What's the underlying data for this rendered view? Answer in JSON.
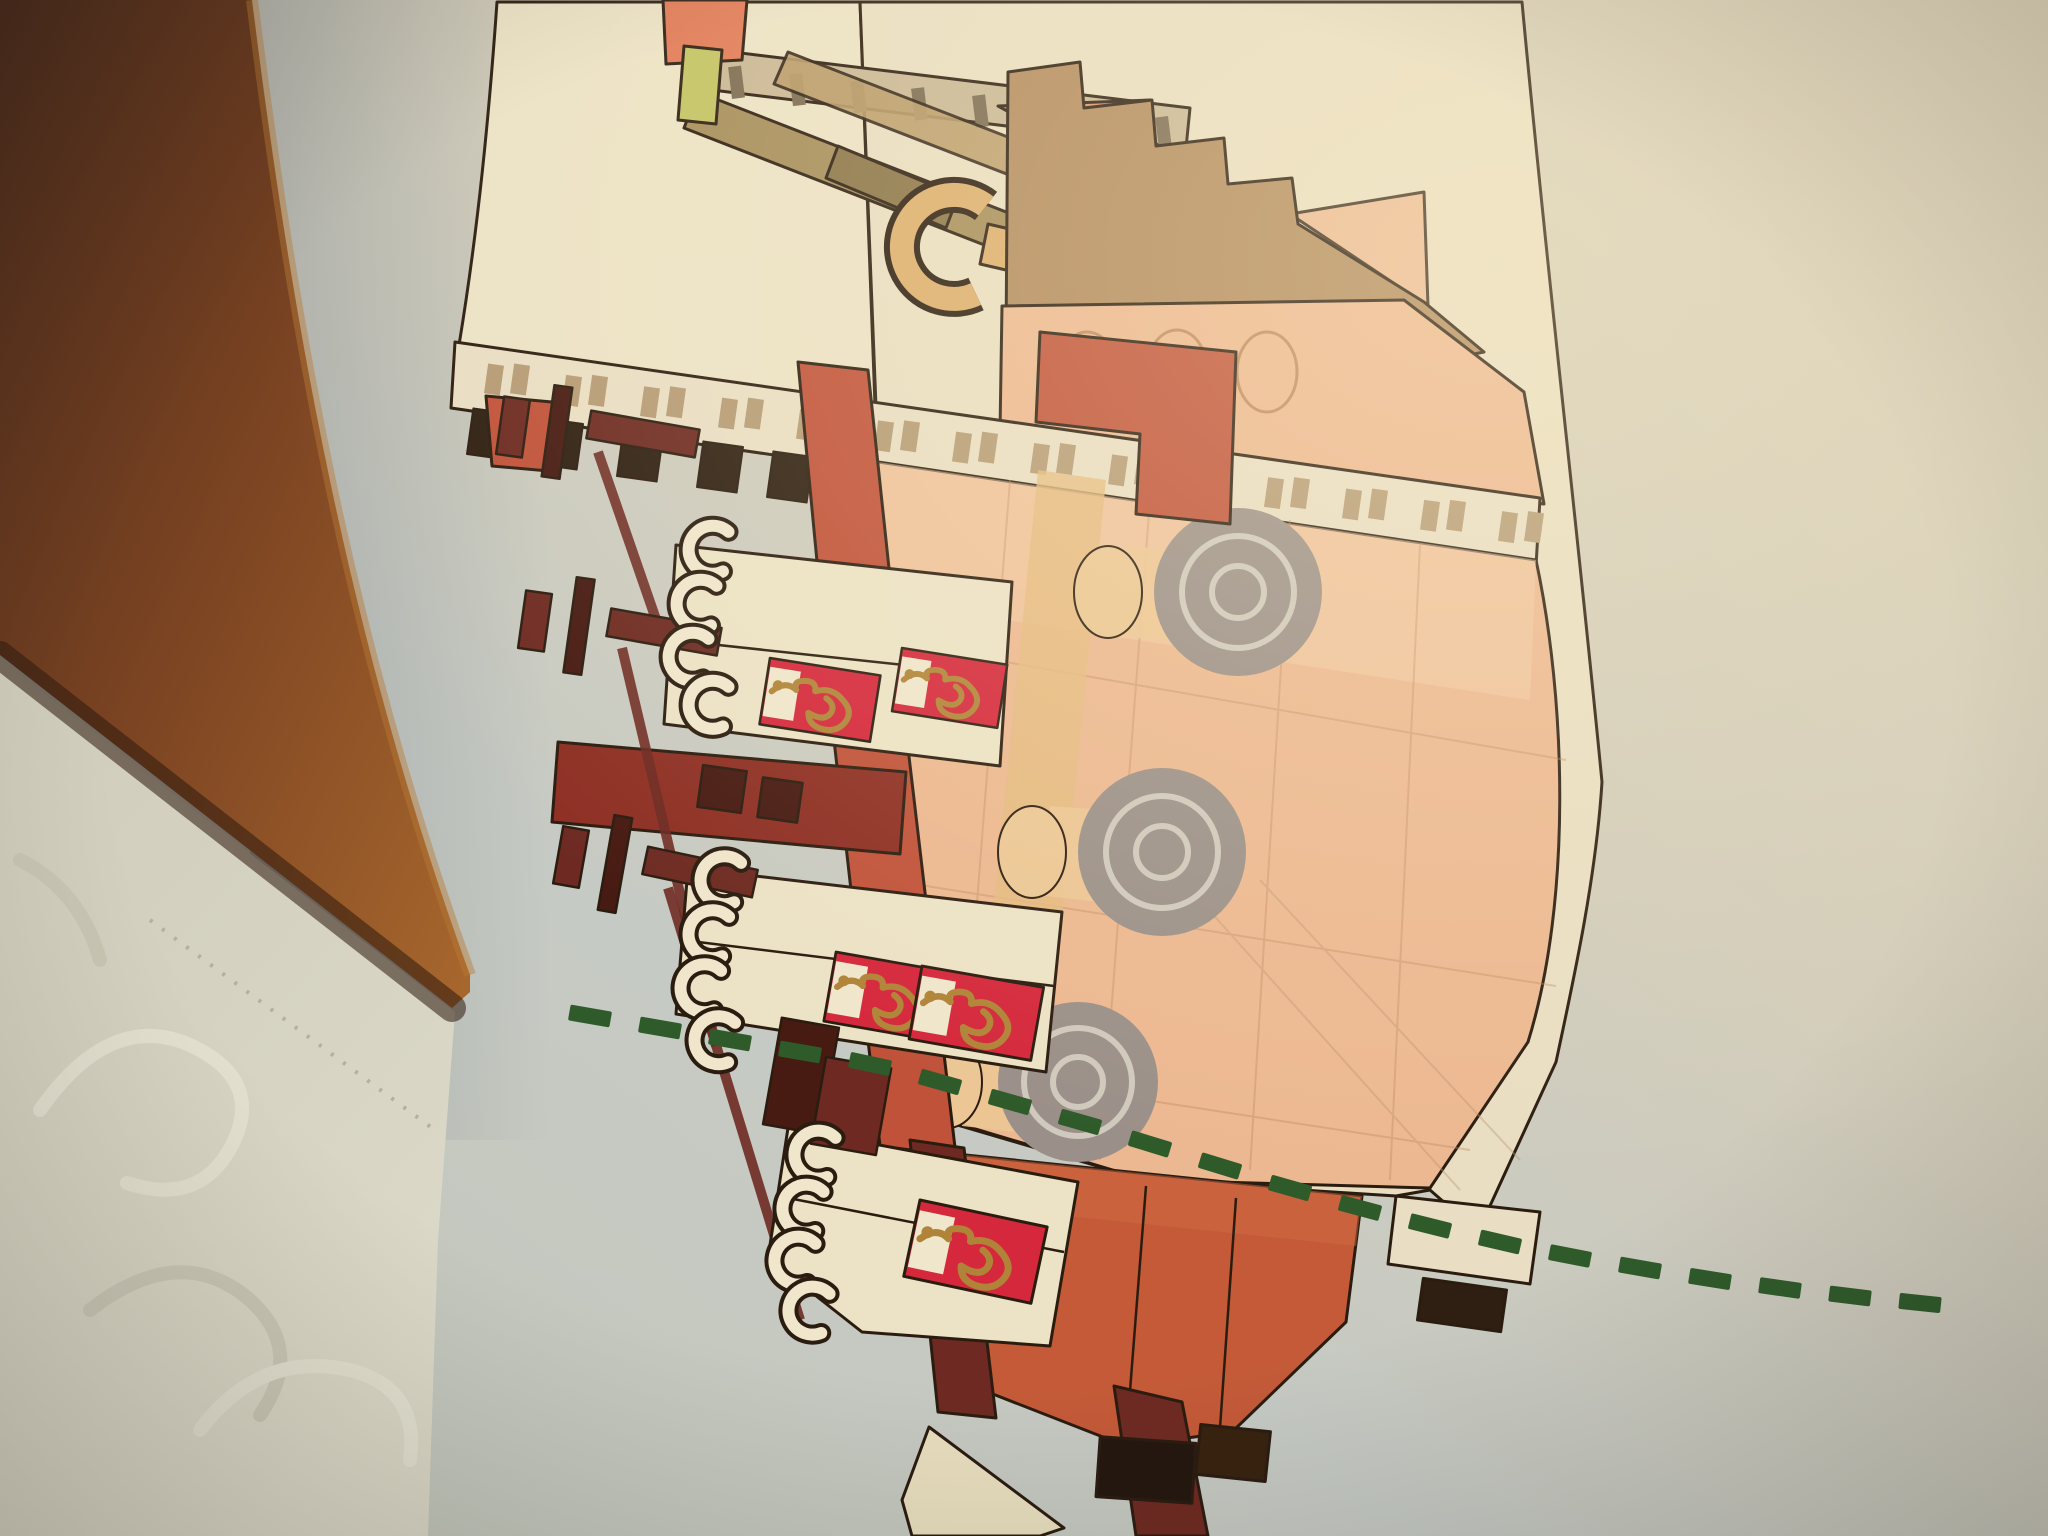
{
  "scene": {
    "description": "Photo of a LEGO instruction manual page showing a side-view illustration of a junk ship with batten sails, dragon emblems, peach hull and a dashed green waterline; page lies on a wooden table beside a white damask tablecloth",
    "objects": [
      "wooden-table",
      "damask-tablecloth",
      "instruction-page",
      "junk-ship-illustration",
      "batten-sails",
      "dragon-sail-panels",
      "hull",
      "stern-castle",
      "bowsprit",
      "figurehead",
      "keel",
      "rudder",
      "waterline"
    ]
  },
  "colors": {
    "outline": "#2b1c10",
    "wood_dark": "#48291a",
    "wood_mid": "#7c4422",
    "wood_light": "#a8672d",
    "wood_edge_hi": "#b97a35",
    "wood_shadow": "#2e1a0e",
    "cloth": "#d8d5c4",
    "cloth_lo": "#c6c3b1",
    "cloth_hi": "#e7e4d4",
    "stitch": "#b3b09e",
    "page_cool": "#c1c8ca",
    "page_mid": "#cdccba",
    "page_warm": "#dbd0b6",
    "sail_cream": "#ece2c6",
    "sail_cream2": "#e9dec2",
    "deck_plate": "#e9dec4",
    "plate_tick": "#b59b76",
    "teeth_dark": "#2e1f12",
    "flag_orange": "#e17a58",
    "flag_lime": "#c2c363",
    "spar_tan": "#a68d5b",
    "spar_dark": "#8a7448",
    "yard_tan": "#b99a68",
    "rail_tan": "#c9b796",
    "rail_post": "#7a6a52",
    "figurehead_tan": "#dcae6e",
    "brick_tan": "#d8a86a",
    "brick_tan2": "#e2bb80",
    "tri_orange": "#dc9368",
    "castle_brown": "#b28a5e",
    "castle_shadow": "#8f6b44",
    "hull_peach": "#ecb891",
    "hull_peach_light": "#f2cda9",
    "hull_seam": "#c08a60",
    "pencil": "#b9946f",
    "disc_gray": "#9b9089",
    "disc_ring": "#d0c9bd",
    "cyl_tan": "#ecc795",
    "tan_strip": "#e5ba80",
    "red_structure": "#c0523a",
    "red_dark": "#8e2f24",
    "keel_red": "#c45a38",
    "keel_hi": "#d06a44",
    "maroon": "#6e2a22",
    "maroon_dark": "#471a12",
    "panel_red": "#d5283c",
    "panel_cream": "#efe6cc",
    "dragon_gold": "#b08438",
    "waterline_green": "#2f5b2b",
    "rudder_cream": "#e9dfbf",
    "block_black": "#241710",
    "block_brown": "#38220f"
  },
  "waterline": {
    "dash_w": 42,
    "dash_h": 16,
    "dashes": [
      [
        590,
        1016,
        10
      ],
      [
        660,
        1028,
        10
      ],
      [
        730,
        1040,
        10
      ],
      [
        800,
        1052,
        10
      ],
      [
        870,
        1064,
        12
      ],
      [
        940,
        1082,
        16
      ],
      [
        1010,
        1102,
        16
      ],
      [
        1080,
        1122,
        16
      ],
      [
        1150,
        1144,
        17
      ],
      [
        1220,
        1166,
        17
      ],
      [
        1290,
        1188,
        16
      ],
      [
        1360,
        1208,
        15
      ],
      [
        1430,
        1226,
        14
      ],
      [
        1500,
        1242,
        13
      ],
      [
        1570,
        1256,
        11
      ],
      [
        1640,
        1268,
        10
      ],
      [
        1710,
        1279,
        9
      ],
      [
        1780,
        1288,
        8
      ],
      [
        1850,
        1296,
        7
      ],
      [
        1920,
        1303,
        6
      ]
    ]
  },
  "teeth": [
    [
      470,
      411
    ],
    [
      540,
      421
    ],
    [
      620,
      433
    ],
    [
      700,
      444
    ],
    [
      770,
      454
    ],
    [
      840,
      465
    ],
    [
      1050,
      495
    ],
    [
      1120,
      505
    ],
    [
      1190,
      516
    ],
    [
      1260,
      526
    ],
    [
      1330,
      536
    ],
    [
      1400,
      546
    ],
    [
      1470,
      556
    ]
  ],
  "plate_ticks": [
    486,
    564,
    642,
    720,
    798,
    876,
    954,
    1032,
    1110,
    1188,
    1266,
    1344,
    1422,
    1500
  ],
  "railing_posts": [
    730,
    791,
    852,
    913,
    974,
    1035,
    1096,
    1157
  ],
  "hooks": {
    "glyph": "M26,-20 A24,24 0 1 0 26,20",
    "positions": [
      [
        700,
        548,
        8
      ],
      [
        688,
        602,
        8
      ],
      [
        680,
        655,
        8
      ],
      [
        700,
        703,
        8
      ],
      [
        712,
        878,
        10
      ],
      [
        700,
        932,
        10
      ],
      [
        692,
        986,
        10
      ],
      [
        706,
        1038,
        10
      ],
      [
        806,
        1152,
        12
      ],
      [
        794,
        1206,
        12
      ],
      [
        786,
        1258,
        12
      ],
      [
        800,
        1308,
        12
      ]
    ]
  },
  "panels": {
    "w": 130,
    "h": 78,
    "dragon": "M8,38 q14,-16 28,-6 q-6,-10 8,-12 q14,-2 14,10 q18,-8 32,4 q16,12 8,26 q-8,14 -26,12 q-16,-2 -18,-16 q20,8 26,-4 q4,-10 -8,-16",
    "items": [
      [
        770,
        658,
        9,
        0.86
      ],
      [
        902,
        648,
        9,
        0.82
      ],
      [
        836,
        952,
        10,
        0.9
      ],
      [
        922,
        966,
        10,
        0.95
      ],
      [
        920,
        1200,
        12,
        1.0
      ]
    ]
  },
  "swirls": [
    {
      "d": "M40,1110 q70,-100 150,-65 q75,35 42,100 q-32,62 -105,38",
      "c": "cloth_hi"
    },
    {
      "d": "M90,1310 q90,-70 160,-10 q55,50 10,115",
      "c": "cloth_lo"
    },
    {
      "d": "M200,1430 q60,-80 150,-60 q70,18 60,90",
      "c": "cloth_hi"
    },
    {
      "d": "M20,860 q60,30 80,100",
      "c": "cloth_lo"
    }
  ]
}
